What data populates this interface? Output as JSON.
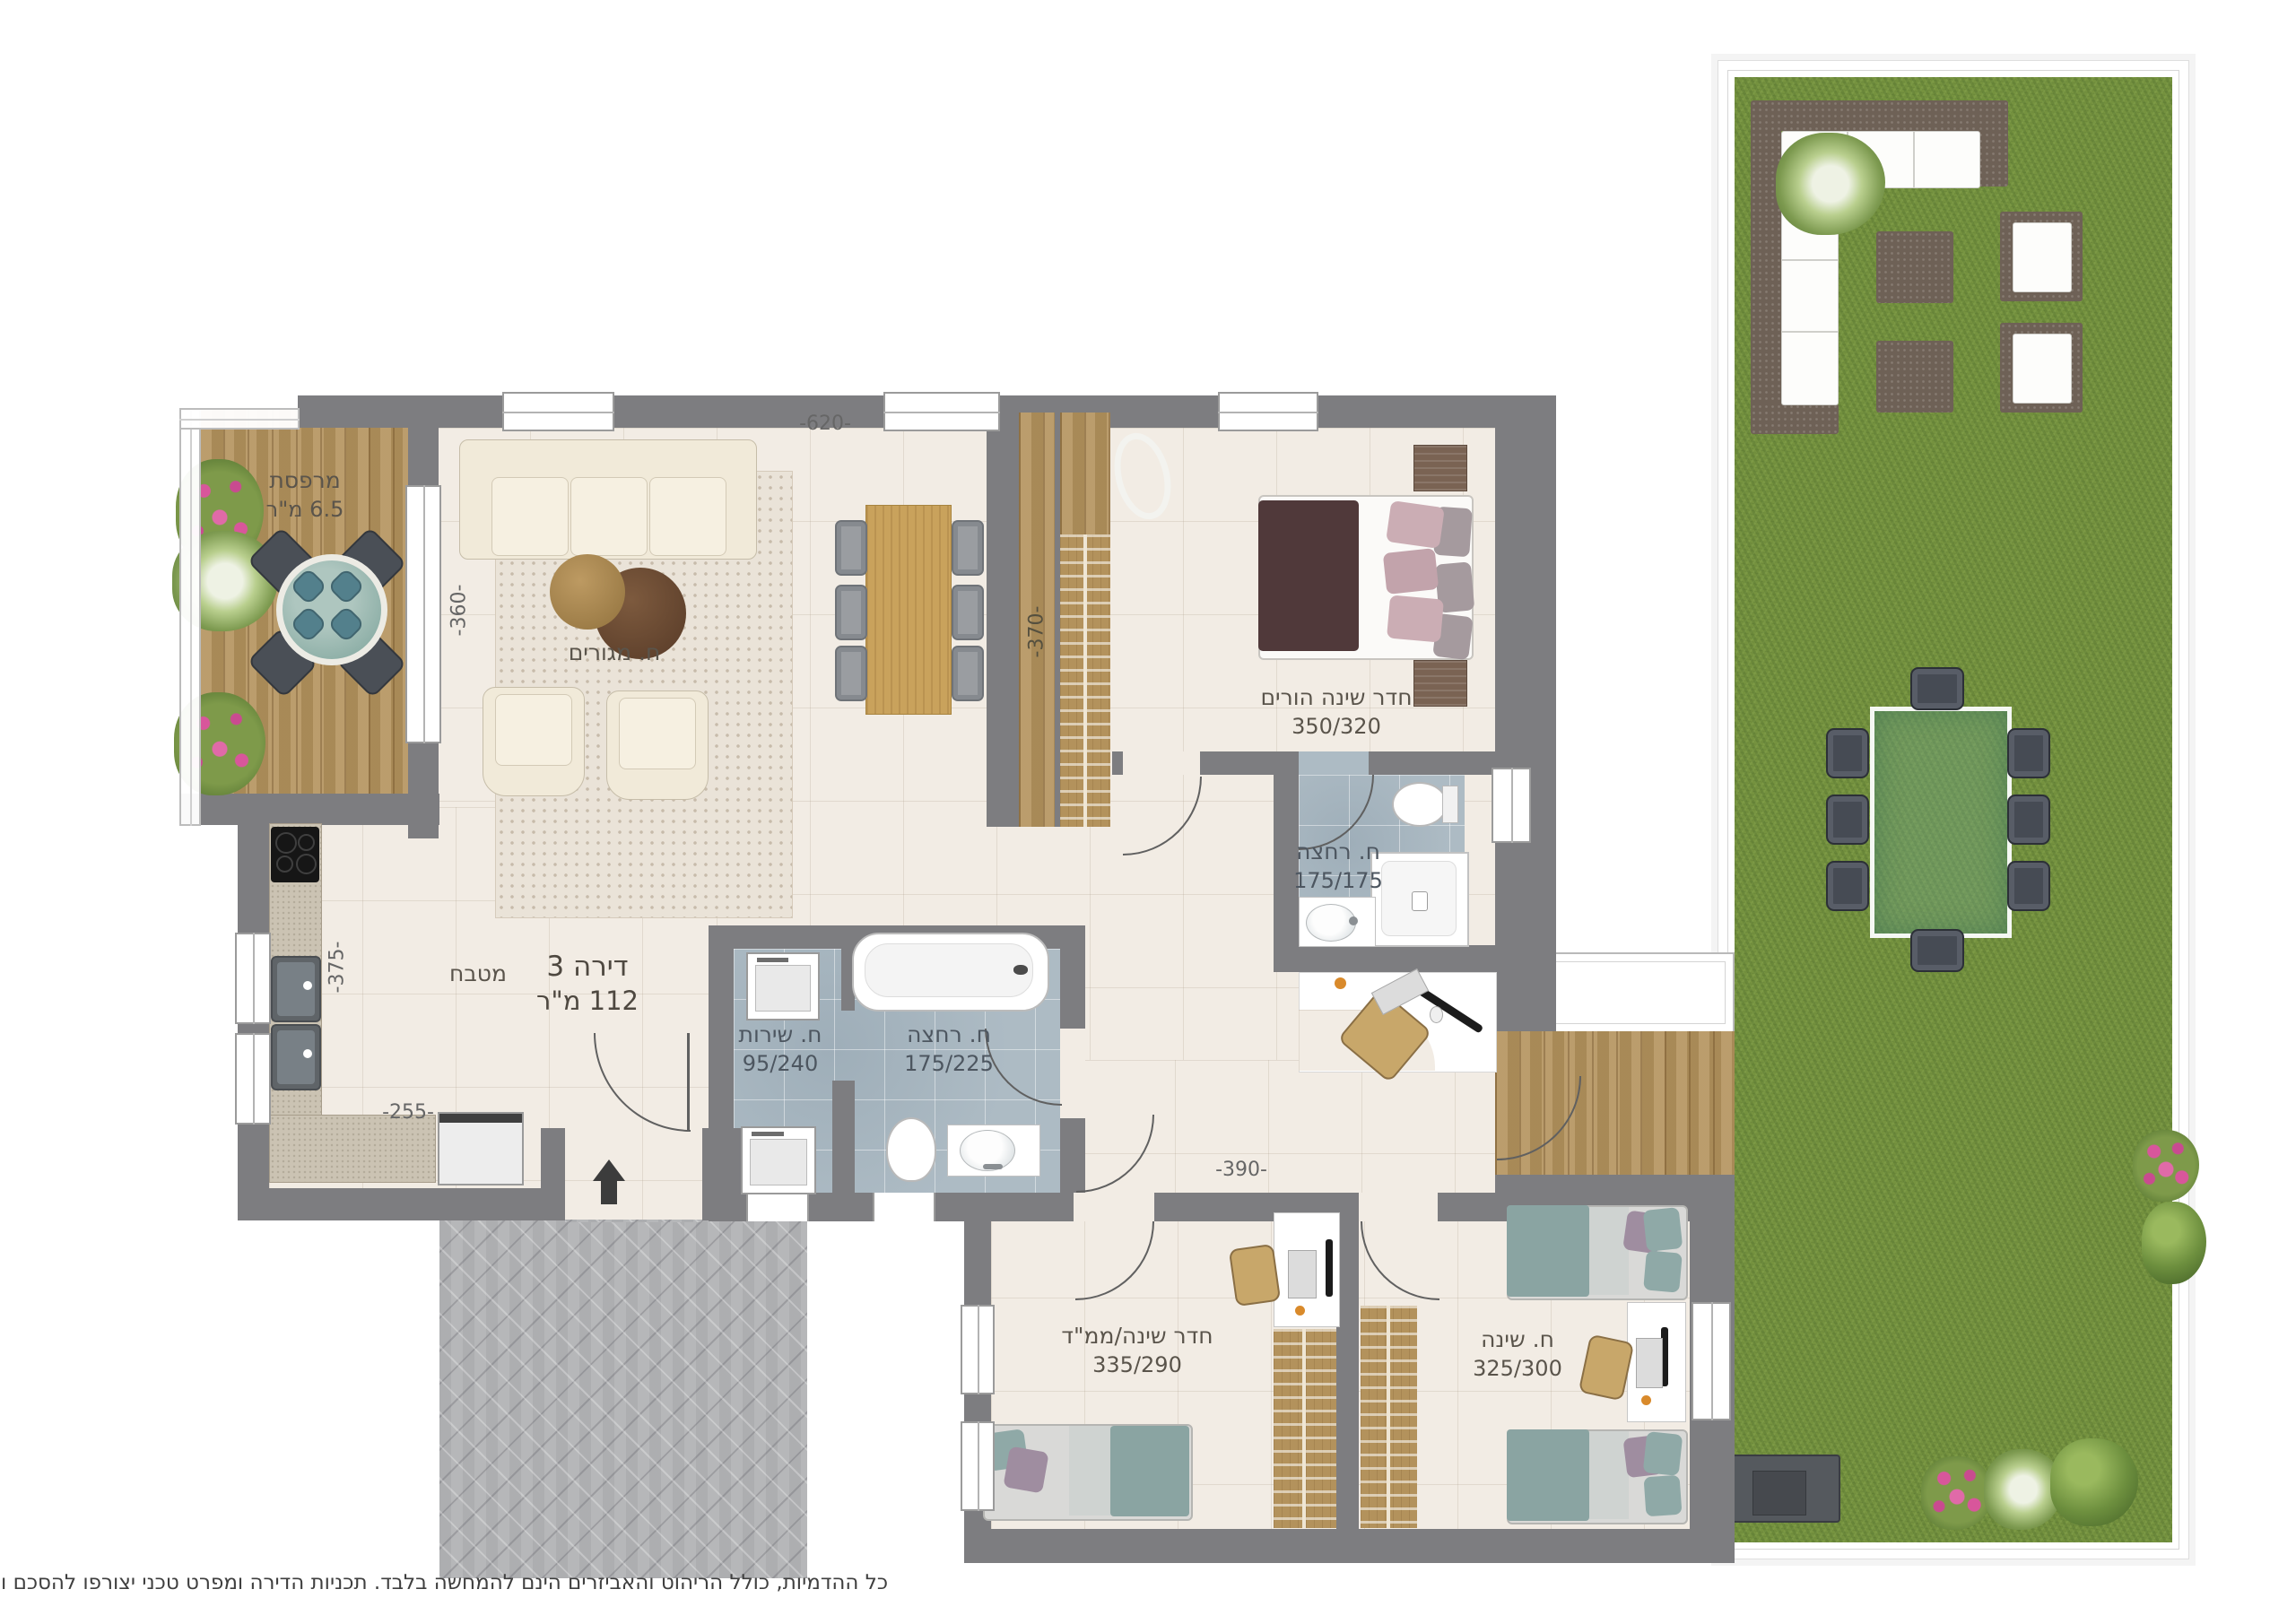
{
  "title": {
    "name": "דירה 3",
    "area": "112 מ\"ר"
  },
  "rooms": {
    "balcony": {
      "name": "מרפסת",
      "area": "6.5 מ\"ר"
    },
    "living": {
      "name": "ח. מגורים"
    },
    "kitchen": {
      "name": "מטבח"
    },
    "master_bedroom": {
      "name": "חדר שינה הורים",
      "dims": "350/320"
    },
    "master_bath": {
      "name": "ח. רחצה",
      "dims": "175/175"
    },
    "service": {
      "name": "ח. שירות",
      "dims": "95/240"
    },
    "bathroom": {
      "name": "ח. רחצה",
      "dims": "175/225"
    },
    "safe_room": {
      "name": "חדר שינה/ממ\"ד",
      "dims": "335/290"
    },
    "bedroom": {
      "name": "ח. שינה",
      "dims": "325/300"
    }
  },
  "dimensions": {
    "living_width": "-620-",
    "living_depth": "-360-",
    "hall_depth": "-370-",
    "kitchen_depth": "-375-",
    "kitchen_width": "-255-",
    "corridor_width": "-390-"
  },
  "disclaimer": "כל ההדמיות, כולל הריהוט והאביזרים הינם להמחשה בלבד. תכניות הדירה ומפרט טכני יצורפו להסכם והם בלבד יחייבו את החברה.",
  "colors": {
    "wall": "#7d7d80",
    "floor": "#f2ece4",
    "bath": "#adbbc4",
    "wood": "#b3925c",
    "grass": "#75923f",
    "rug": "#eae3d8",
    "sofa": "#f1ead9",
    "paving": "#b6b7b9",
    "label": "#5a544b",
    "dim": "#666666"
  }
}
